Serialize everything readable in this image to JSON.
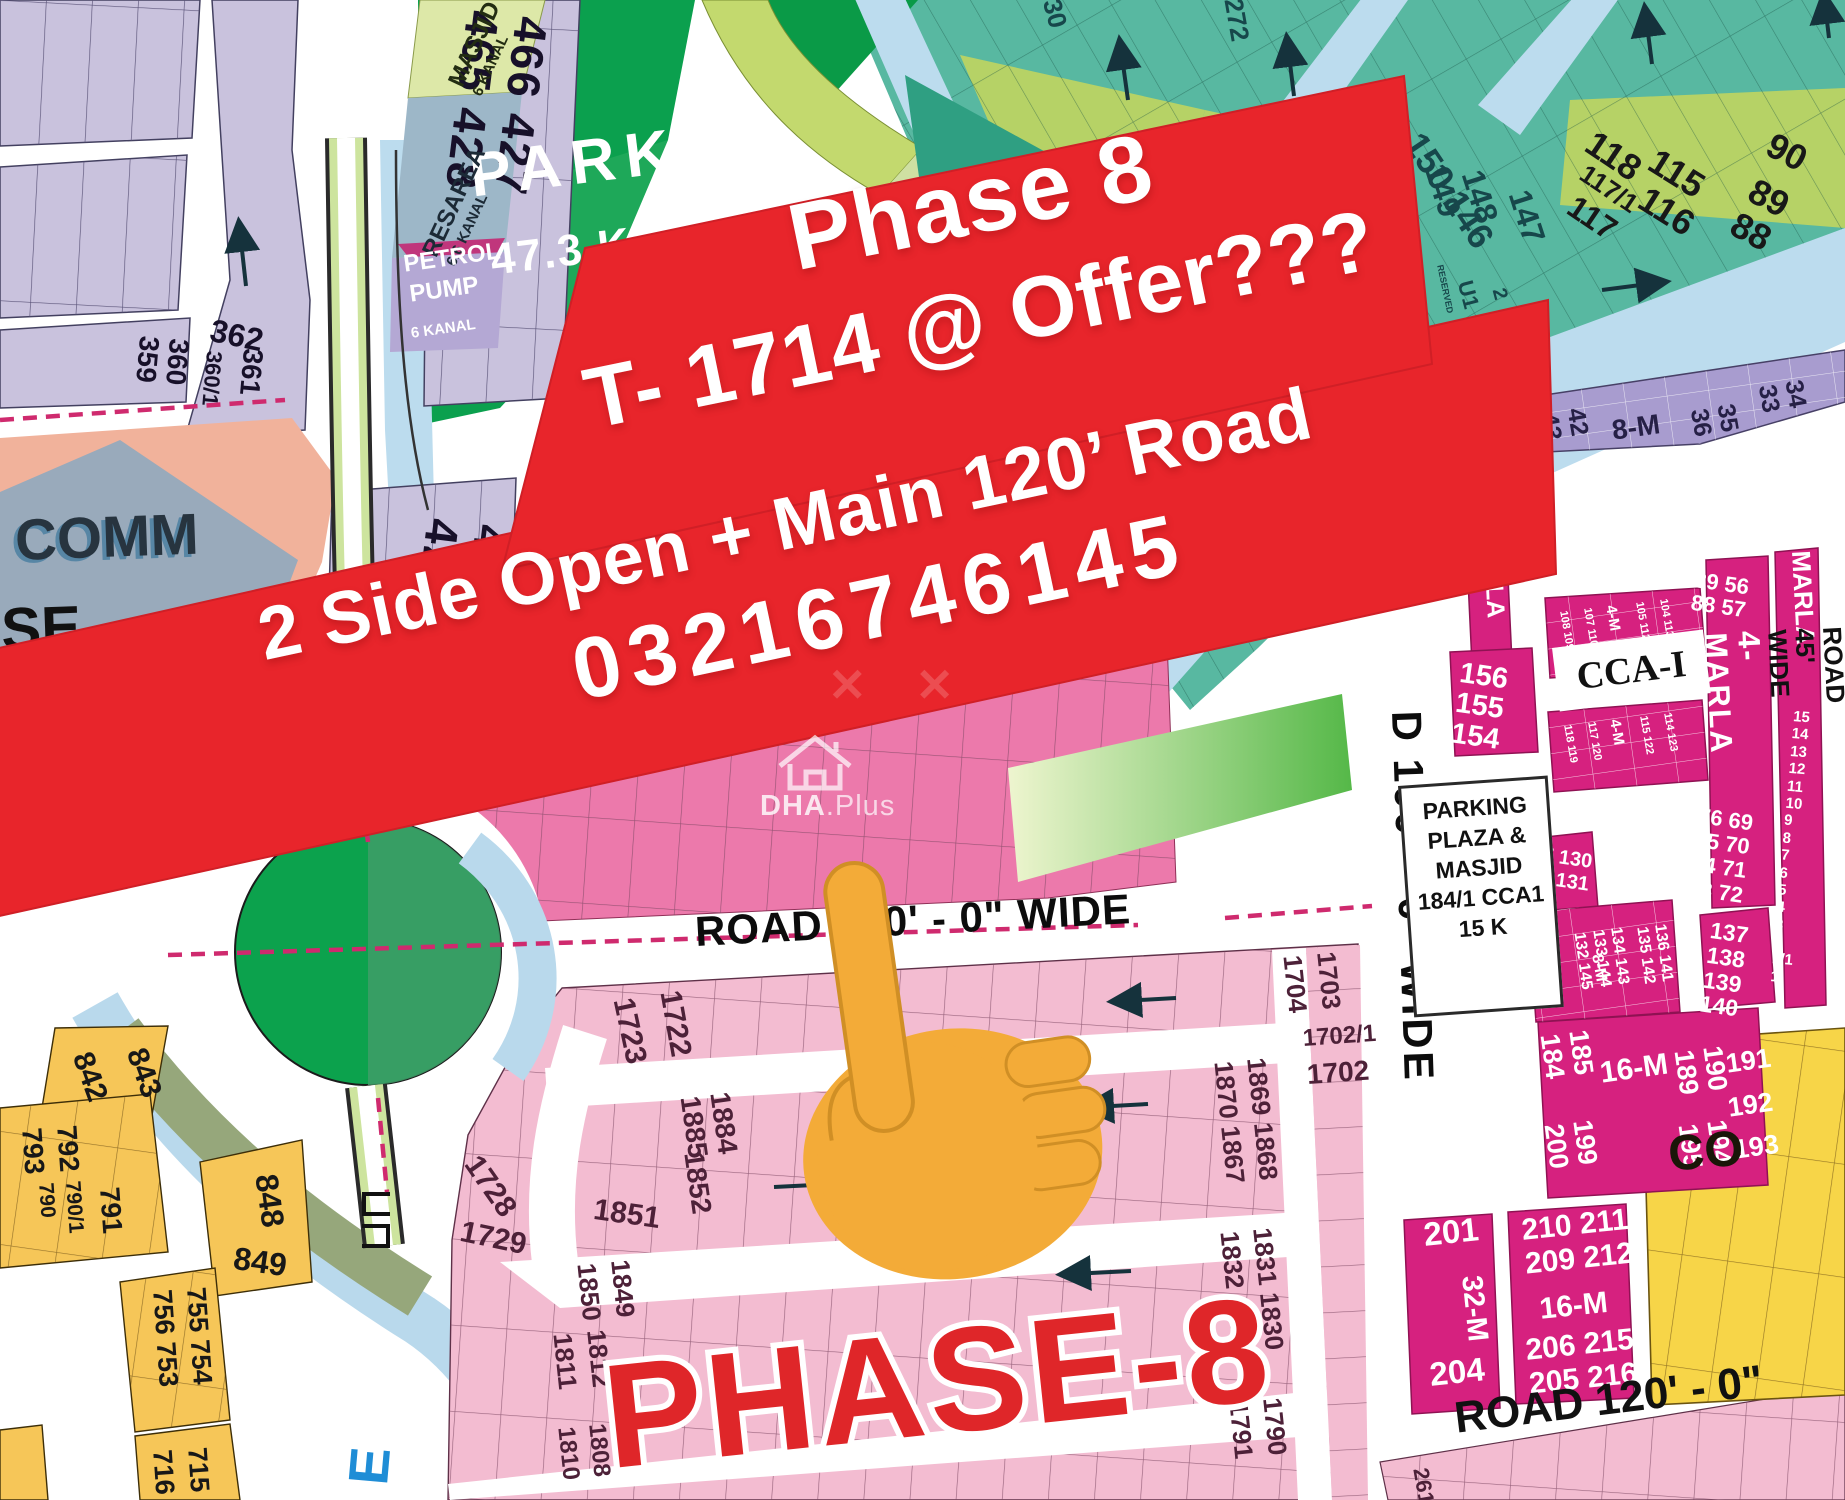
{
  "banner": {
    "line1": "Phase 8",
    "line2": "T- 1714 @ Offer???",
    "line3": "2 Side Open + Main 120’ Road",
    "phone": "03216746145"
  },
  "watermark": {
    "brand_bold": "DHA",
    "brand_rest": ".Plus",
    "pattern": "✕ ✕"
  },
  "labels": {
    "park_main_name": "PARK",
    "park_main_size": "47.3 K",
    "park_small": "PARK\n5.7 K",
    "masjid_l1": "MASJID",
    "masjid_l2": "6 KANAL",
    "resarea_l1": "RESAREA",
    "resarea_l2": "6.6 KANAL",
    "petrol_l1": "PETROL",
    "petrol_l2": "PUMP",
    "petrol_l3": "6 KANAL",
    "comm": "COMM",
    "se": "SE",
    "pment": "PMENT",
    "k": "K",
    "slash1": "/1",
    "road120_mid": "ROAD 120' - 0\" WIDE",
    "road100_vert": "D 100' - 0\" WIDE",
    "road45_vert": "ROAD 45' WIDE",
    "road120_br": "ROAD 120' - 0\"",
    "phase8_big": "PHASE-8",
    "parking_l1": "PARKING",
    "parking_l2": "PLAZA &",
    "parking_l3": "MASJID",
    "parking_l4": "184/1 CCA1",
    "parking_l5": "15 K",
    "cca": "CCA-I",
    "co": "CO",
    "e": "E",
    "u1": "U1",
    "u2": "2",
    "reserved_a": "RESERVED",
    "reserved_b": "RESERVED",
    "m8_strip": "8-M",
    "m8_block": "8-M",
    "m16_a": "16-M",
    "m16_b": "16-M",
    "m32": "32-M",
    "m4_a": "4-M",
    "m4_b": "4-M",
    "marla_full": "4-MARLA",
    "marla_part": "MARLA",
    "marla_la": "LA"
  },
  "plots": {
    "lav_pair1": "466 427\n465 428",
    "lav_pair2": "426 375\n425 376",
    "lav_362": "362",
    "lav_361": "361",
    "lav_360_1": "360/1",
    "lav_pair3": "360\n359",
    "g_272": "272",
    "g_30": "30",
    "g_289": "289 277",
    "g_288": "288",
    "g_279": "279",
    "g_278": "278",
    "g_242": "242 238",
    "g_240": "240\n241",
    "g_239": "239",
    "g_280": "280\n281",
    "g_150": "150 146",
    "g_149": "149",
    "g_148": "148",
    "g_147": "147",
    "g_118": "118",
    "g_117_1": "117/1",
    "g_117": "117",
    "g_115": "115",
    "g_116": "116",
    "g_90": "90",
    "g_89": "89 88",
    "p_42": "42\n43",
    "p_35": "35\n36",
    "p_34": "34\n33",
    "m_156": "156\n155\n154",
    "m_8956": "89 56\n88 57",
    "m_76": "76 69\n75 70\n74 71\n73 72",
    "m_137": "137\n138\n139\n140",
    "m_147": "147 130\n146 131",
    "m_blk1": "136 141\n135 142",
    "m_blk2": "134 143\n133 144\n132 145",
    "m_g1a": "108 109",
    "m_g1b": "107 110",
    "m_g1c": "105 112",
    "m_g1d": "104 113",
    "m_g2a": "118 119",
    "m_g2b": "117 120",
    "m_g2c": "115 122",
    "m_g2d": "114 123",
    "m_185": "185\n184",
    "m_199": "199\n200",
    "m_190": "190\n189",
    "m_194": "194\n195",
    "m_191": "191",
    "m_192": "192",
    "m_193": "193",
    "m_201": "201",
    "m_204": "204",
    "m_210": "210 211\n209 212",
    "m_206": "206 215\n205 216",
    "m_col15": "15\n14\n13\n12\n11\n10\n9\n8\n7\n6\n5\n4\n3\n2\n1/1\n1",
    "m_261": "261 9",
    "pk_1723": "1723",
    "pk_1722": "1722",
    "pk_1728": "1728",
    "pk_1729": "1729",
    "pk_1884": "1884\n1885",
    "pk_1852": "1852",
    "pk_1851": "1851",
    "pk_1869": "1869 1868\n1870 1867",
    "pk_1849": "1849\n1850",
    "pk_1812": "1812\n1811",
    "pk_1808": "1808\n1810",
    "pk_1831": "1831 1830\n1832 1829",
    "pk_1790": "1790\n1791",
    "pk_1703": "1703\n1704",
    "pk_1702_1": "1702/1",
    "pk_1702": "1702",
    "y_843": "843",
    "y_842": "842",
    "y_848": "848",
    "y_849": "849",
    "y_792": "792\n793",
    "y_790": "790/1\n790",
    "y_791": "791",
    "y_755": "755 754\n756 753",
    "y_715": "715\n716"
  }
}
